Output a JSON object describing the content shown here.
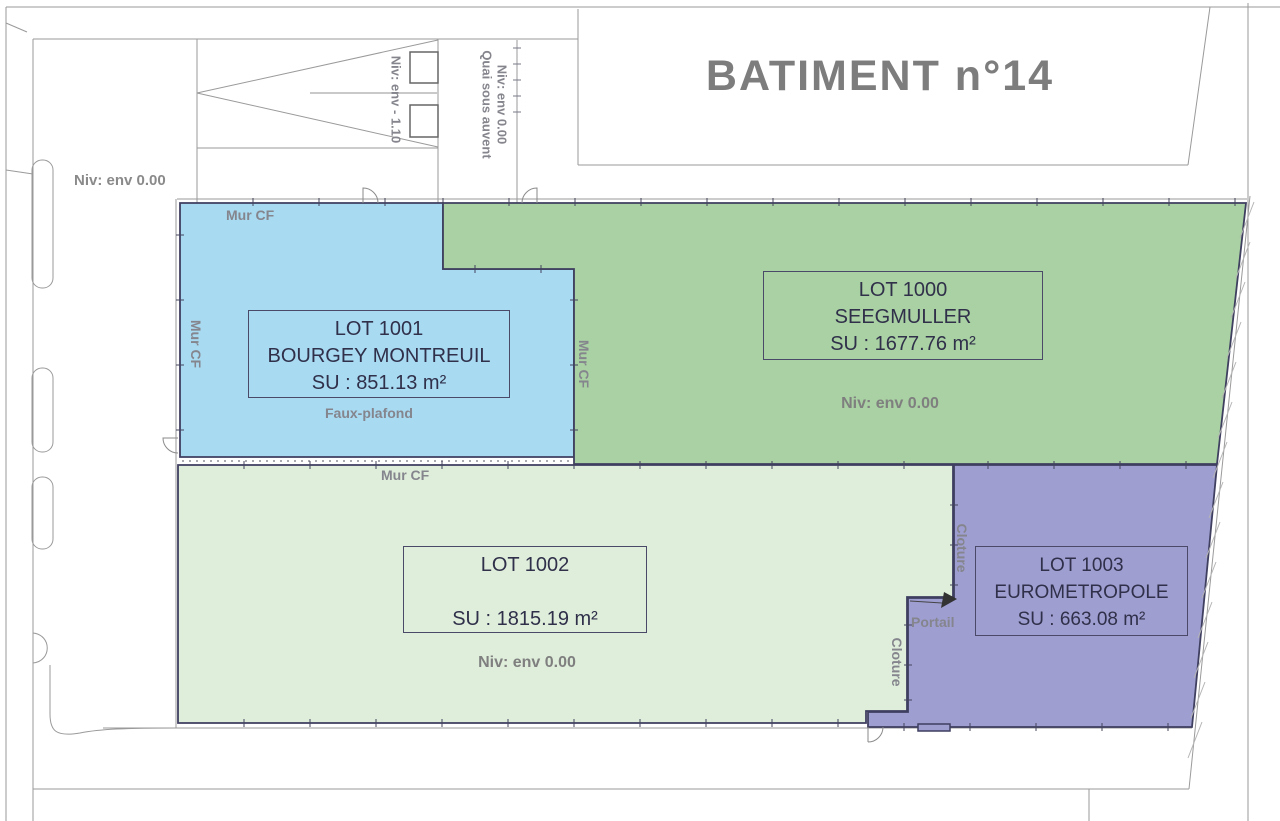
{
  "title": "BATIMENT n°14",
  "labels": {
    "niv0": "Niv: env 0.00",
    "ramp_niv": "Niv: env - 1.10",
    "quai": "Quai sous auvent",
    "mur_cf": "Mur CF",
    "faux_plafond": "Faux-plafond",
    "cloture": "Cloture",
    "portail": "Portail"
  },
  "lots": {
    "lot1000": {
      "id": "LOT 1000",
      "name": "SEEGMULLER",
      "area": "SU : 1677.76 m²",
      "level": "Niv: env 0.00",
      "color": "#a9d1a3"
    },
    "lot1001": {
      "id": "LOT 1001",
      "name": "BOURGEY MONTREUIL",
      "area": "SU : 851.13 m²",
      "color": "#a8daf2"
    },
    "lot1002": {
      "id": "LOT 1002",
      "name": "",
      "area": "SU : 1815.19 m²",
      "level": "Niv: env 0.00",
      "color": "#dfeedb"
    },
    "lot1003": {
      "id": "LOT 1003",
      "name": "EUROMETROPOLE",
      "area": "SU : 663.08 m²",
      "color": "#9e9ed1"
    }
  },
  "colors": {
    "wall": "#3f3f60",
    "site_line": "#9a9a9a",
    "muted_text": "#85858d",
    "title_text": "#7d7d7d",
    "lot_text": "#30304a"
  }
}
